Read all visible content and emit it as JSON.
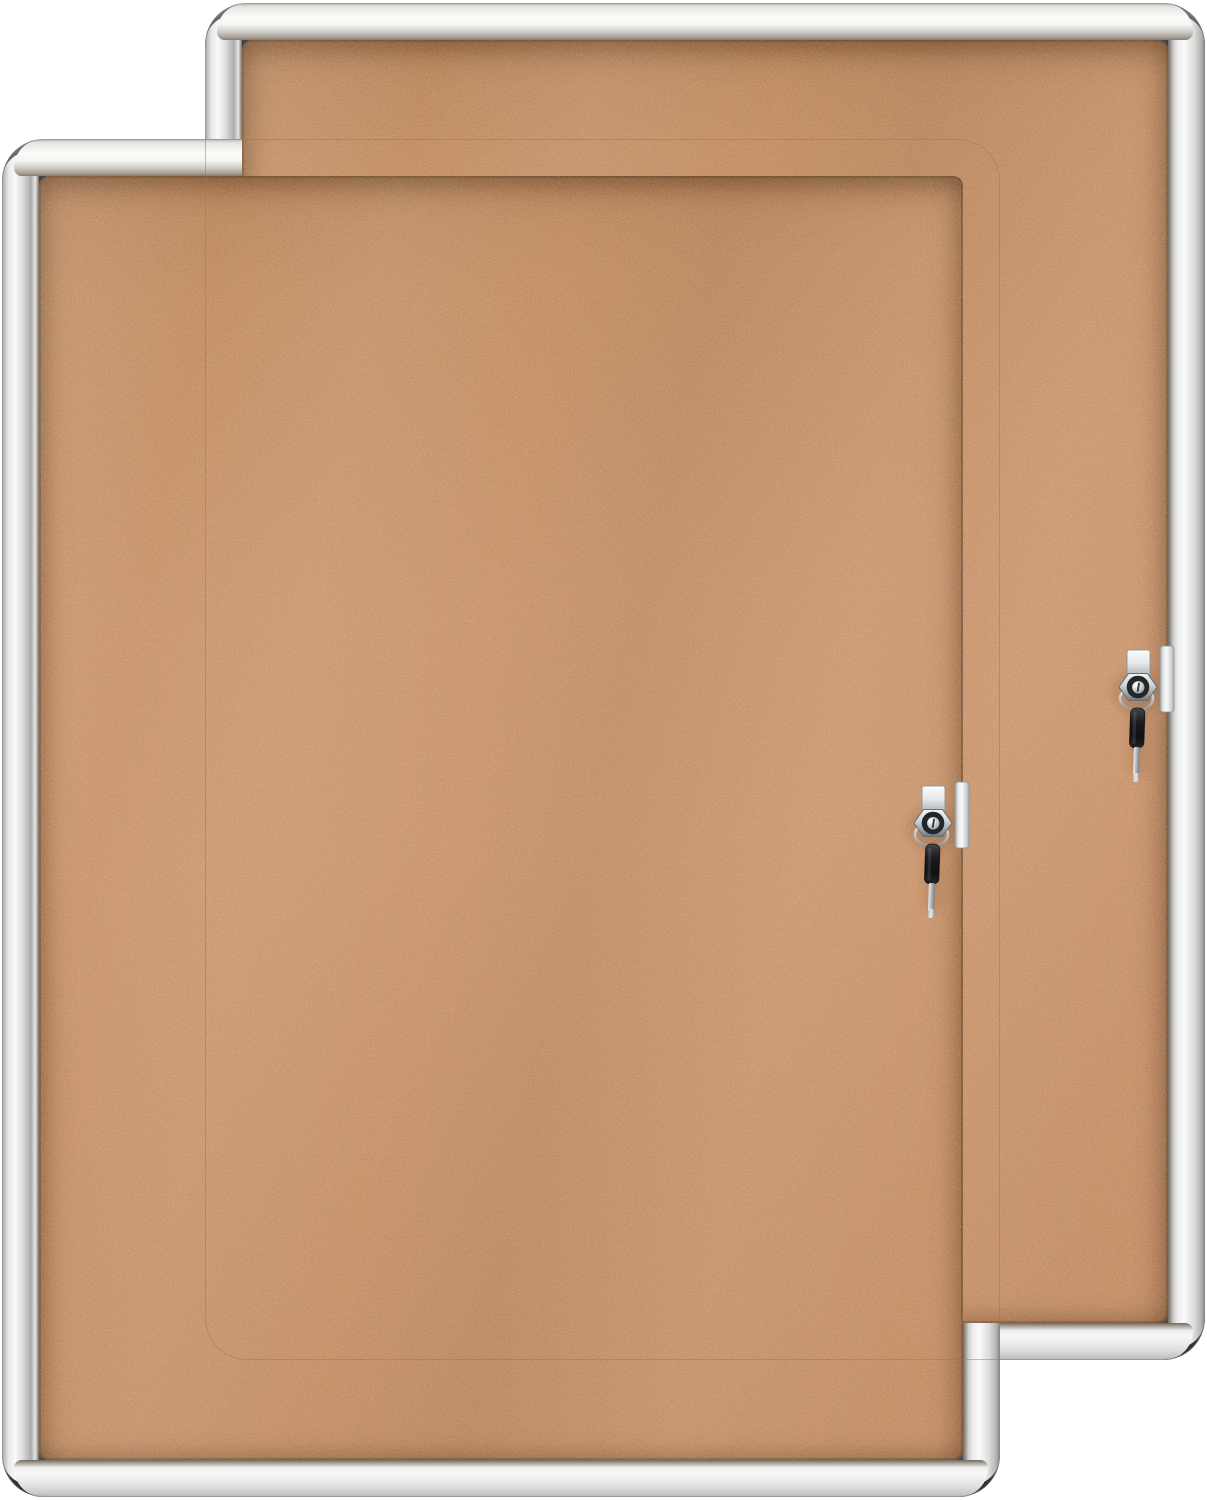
{
  "scene": {
    "description": "Product photograph on a white background of two identical enclosed cork bulletin boards, offset diagonally; each has a silver aluminum frame with rounded dark-gray corner caps, a tan cork surface behind a glass door, and a chrome cam lock on the right edge with a key on a ring hanging from it beside a slim latch handle",
    "item_count": 2,
    "background_color": "#ffffff"
  },
  "boards": {
    "back": {
      "alt": "Rear enclosed cork bulletin board with aluminum frame, lock and hanging key"
    },
    "front": {
      "alt": "Front enclosed cork bulletin board with aluminum frame, lock and hanging key"
    }
  },
  "colors": {
    "cork": "#c48e64",
    "cork_shadow": "#9e734e",
    "frame_highlight": "#fbfbfb",
    "frame_mid": "#d7d7d7",
    "frame_dark": "#8d8d8d",
    "corner_cap_light": "#878c90",
    "corner_cap_dark": "#24292d",
    "chrome_light": "#f2f3f4",
    "chrome_dark": "#7c8286",
    "key_head": "#17181a"
  },
  "lock": {
    "parts": [
      "latch-plate",
      "lock-tab",
      "hex-nut",
      "keyhole",
      "lock-cylinder",
      "key-ring",
      "key"
    ]
  }
}
